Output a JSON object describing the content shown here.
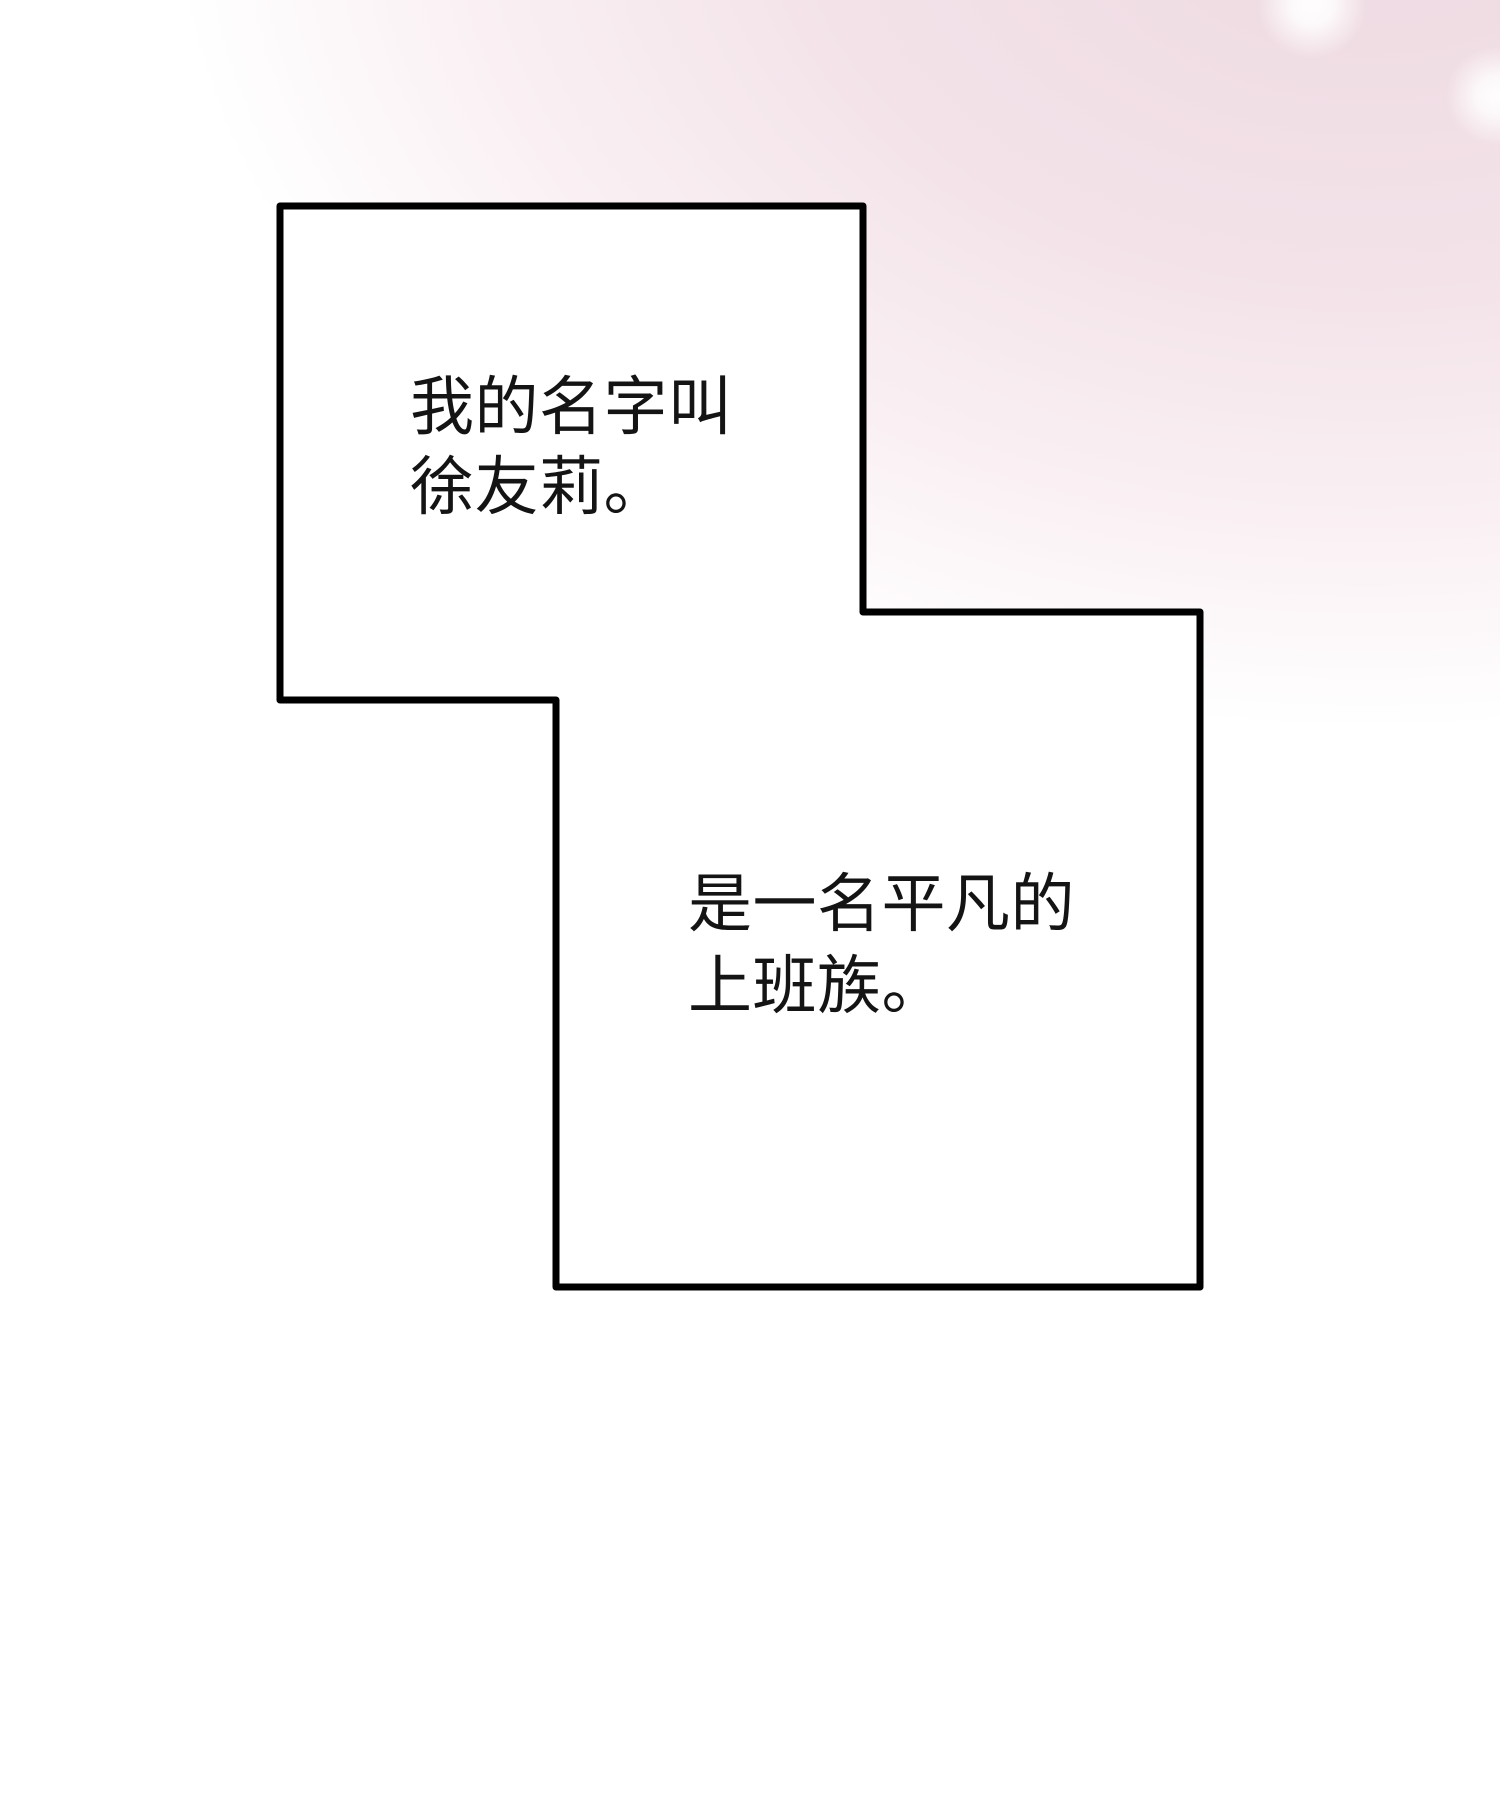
{
  "page_type": "comic-narration-page",
  "colors": {
    "line_color": "#000000",
    "panel_fill": "#ffffff",
    "ink_color": "#141414",
    "glow_pink": "#eed9e1"
  },
  "narration1": {
    "line1": "我的名字叫",
    "line2": "徐友莉。"
  },
  "narration2": {
    "line1": "是一名平凡的",
    "line2": "上班族。"
  }
}
